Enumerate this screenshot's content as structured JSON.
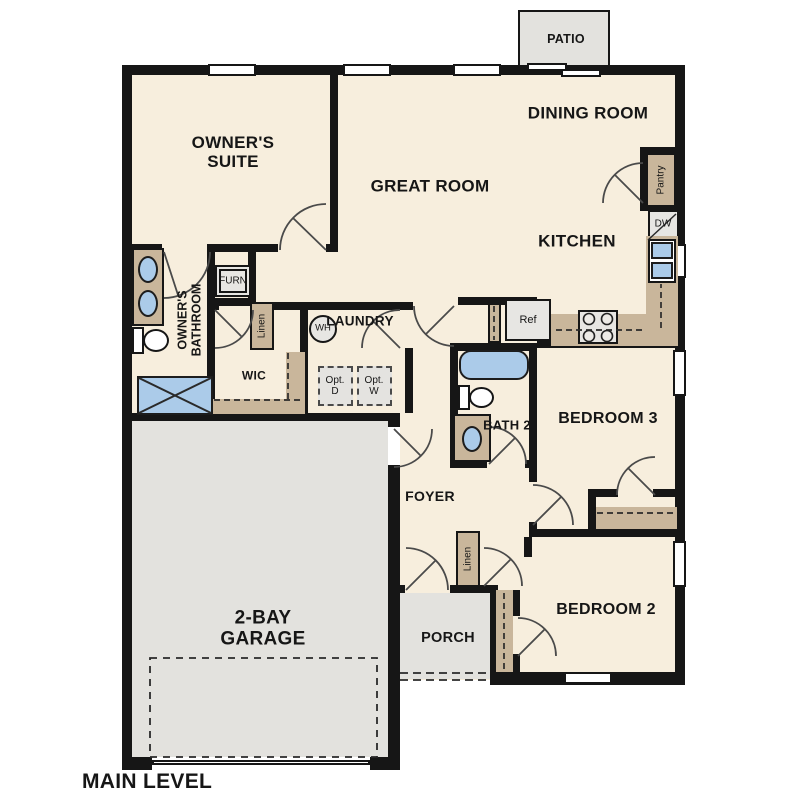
{
  "title": "MAIN LEVEL",
  "rooms": {
    "owners_suite": "OWNER'S SUITE",
    "great_room": "GREAT ROOM",
    "dining_room": "DINING ROOM",
    "kitchen": "KITCHEN",
    "owners_bathroom": "OWNER'S BATHROOM",
    "wic": "WIC",
    "laundry": "LAUNDRY",
    "foyer": "FOYER",
    "bath_2": "BATH 2",
    "bedroom_3": "BEDROOM 3",
    "bedroom_2": "BEDROOM 2",
    "garage": "2-BAY GARAGE",
    "porch": "PORCH",
    "patio": "PATIO"
  },
  "fixtures": {
    "furnace": "FURN",
    "water_heater": "WH",
    "refrigerator": "Ref",
    "dishwasher": "DW",
    "pantry": "Pantry",
    "linen_hall": "Linen",
    "linen_foyer": "Linen",
    "optional_dryer": "Opt. D",
    "optional_washer": "Opt. W"
  },
  "colors": {
    "floor": "#f7eedd",
    "exterior_concrete": "#e3e2de",
    "cabinetry": "#c9b69b",
    "plumbing_blue": "#abcbe9",
    "walls": "#161616"
  }
}
